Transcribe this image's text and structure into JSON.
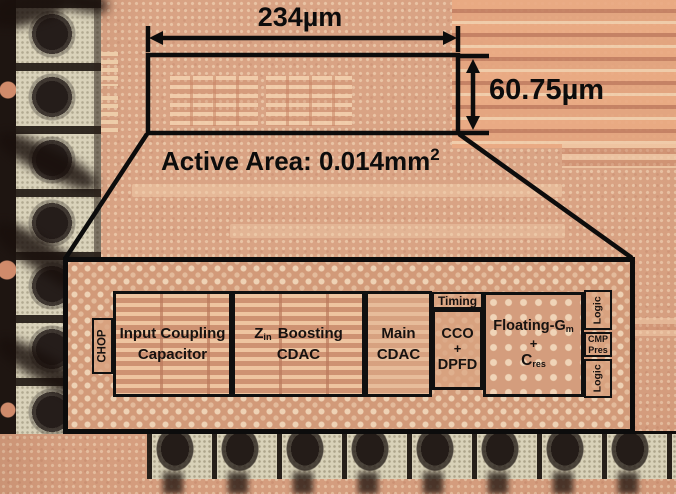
{
  "annotations": {
    "width_label": "234µm",
    "height_label": "60.75µm",
    "active_area_text": "Active Area: 0.014mm",
    "active_area_sup": "2"
  },
  "inset": {
    "blocks": {
      "chop": "CHOP",
      "icc_line1": "Input Coupling",
      "icc_line2": "Capacitor",
      "zin_main": "Z",
      "zin_sub": "in",
      "zin_rest": "Boosting",
      "zin_line2": "CDAC",
      "main_line1": "Main",
      "main_line2": "CDAC",
      "timing": "Timing",
      "cco_line1": "CCO",
      "cco_plus": "+",
      "cco_line3": "DPFD",
      "float_line1": "Floating-G",
      "float_line1_sub": "m",
      "float_plus": "+",
      "float_line3": "C",
      "float_line3_sub": "res",
      "logic_top": "Logic",
      "cmp_line1": "CMP",
      "cmp_line2": "Pres",
      "logic_bottom": "Logic"
    }
  },
  "colors": {
    "annotation_black": "#0c0c0c",
    "die_copper": "#d59b7b",
    "die_dot_light": "#f2d5b6",
    "pad_cream": "#d9d2ba",
    "bond_wire_dark": "#241c18"
  }
}
